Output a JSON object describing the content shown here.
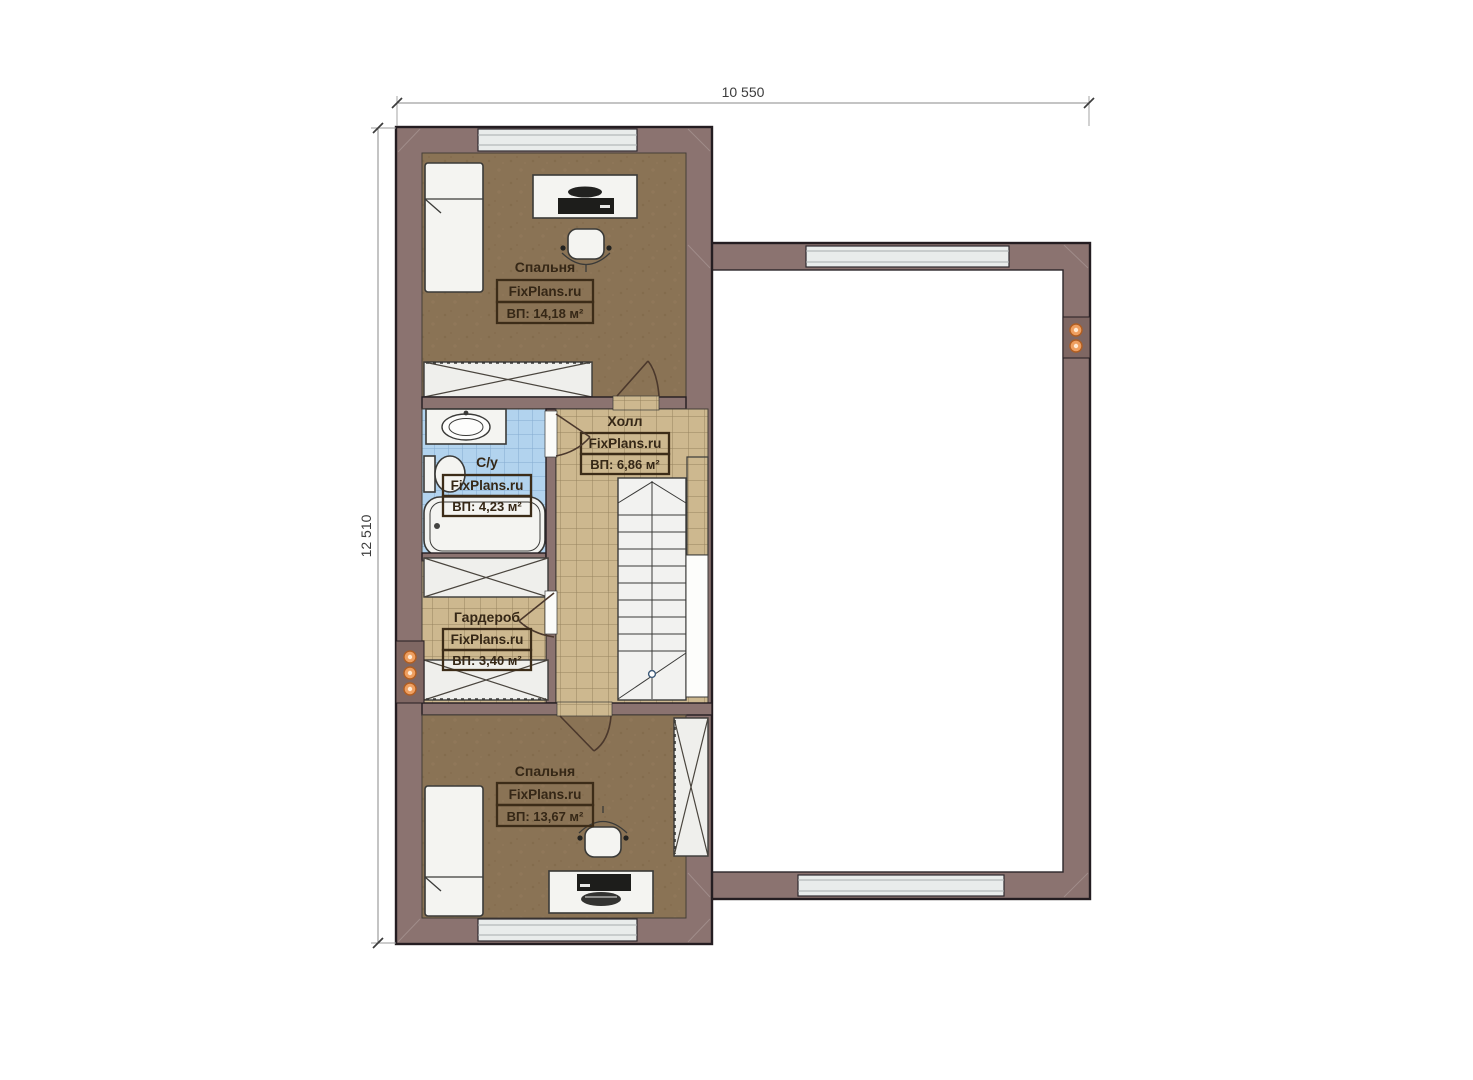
{
  "dimensions": {
    "width": "10 550",
    "height": "12 510"
  },
  "brand": "FixPlans.ru",
  "rooms": {
    "bedroom_top": {
      "name": "Спальня",
      "area": "ВП: 14,18 м²"
    },
    "bathroom": {
      "name": "С/у",
      "area": "ВП: 4,23 м²"
    },
    "hall": {
      "name": "Холл",
      "area": "ВП: 6,86 м²"
    },
    "wardrobe": {
      "name": "Гардероб",
      "area": "ВП: 3,40 м²"
    },
    "bedroom_bottom": {
      "name": "Спальня",
      "area": "ВП: 13,67 м²"
    }
  },
  "colors": {
    "wall": "#8b7370",
    "floor_wood": "#8a7355",
    "floor_tile": "#cdb88f",
    "floor_bath": "#b2d3ee",
    "light_accent": "#ef9f60"
  }
}
